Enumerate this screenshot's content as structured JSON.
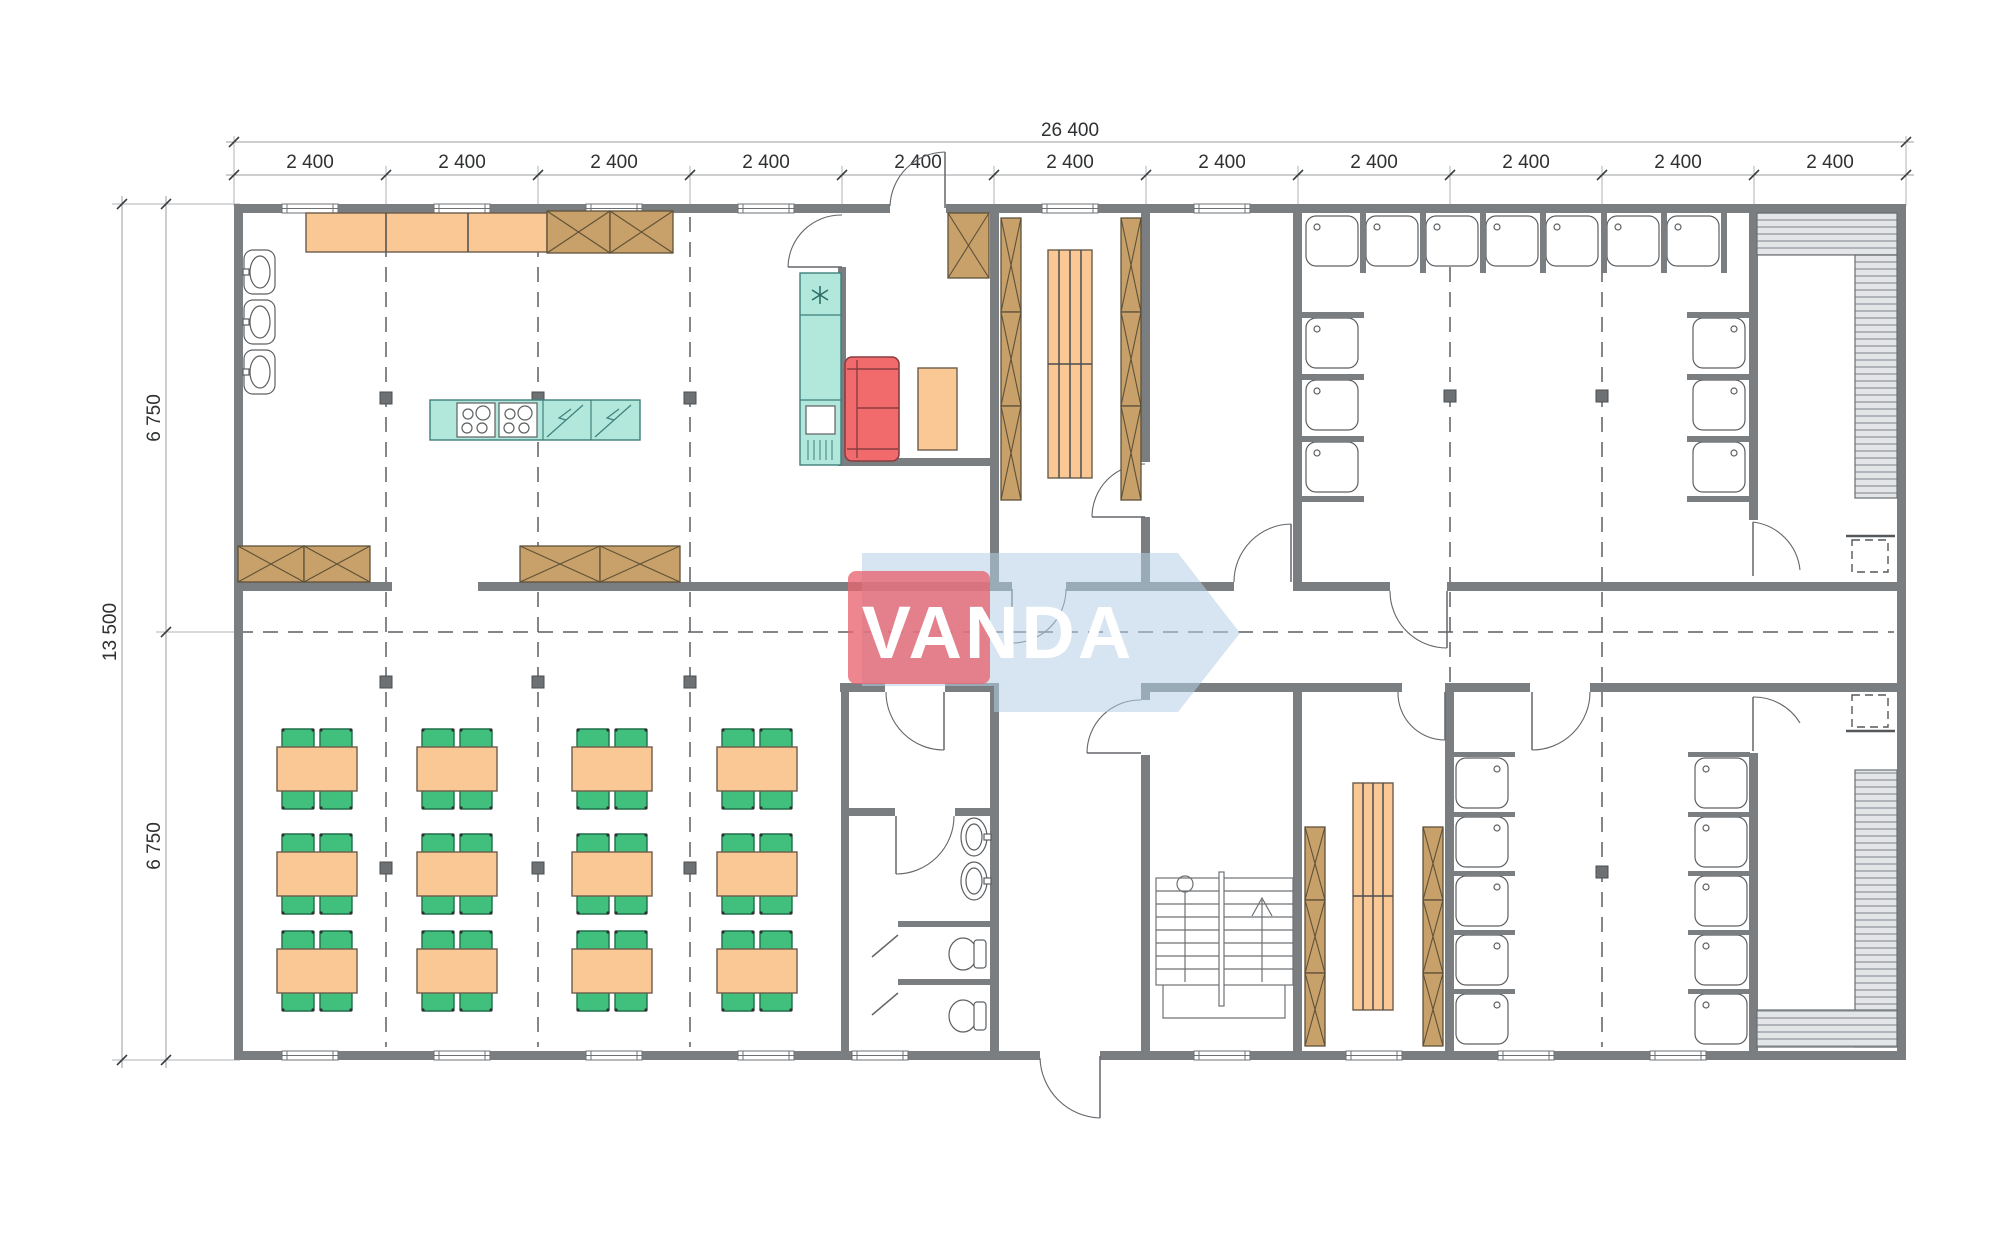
{
  "drawing": {
    "type": "architectural-floor-plan",
    "watermark": {
      "text": "VANDA",
      "red": "#e8646f",
      "blue": "#b5cfe6"
    },
    "dimensions": {
      "top_total": "26 400",
      "top_segments": [
        "2 400",
        "2 400",
        "2 400",
        "2 400",
        "2 400",
        "2 400",
        "2 400",
        "2 400",
        "2 400",
        "2 400",
        "2 400"
      ],
      "left_total": "13 500",
      "left_segments": [
        "6 750",
        "6 750"
      ]
    },
    "colors": {
      "wall_gray": "#7b7e81",
      "furniture_orange": "#f9c894",
      "cabinet_brown": "#c7a06a",
      "counter_teal": "#b2e7dc",
      "chair_green": "#41c07d",
      "sofa_red": "#f26b6c",
      "bench_hatch": "#e3e5e6",
      "line_dark": "#4a4e52"
    }
  }
}
